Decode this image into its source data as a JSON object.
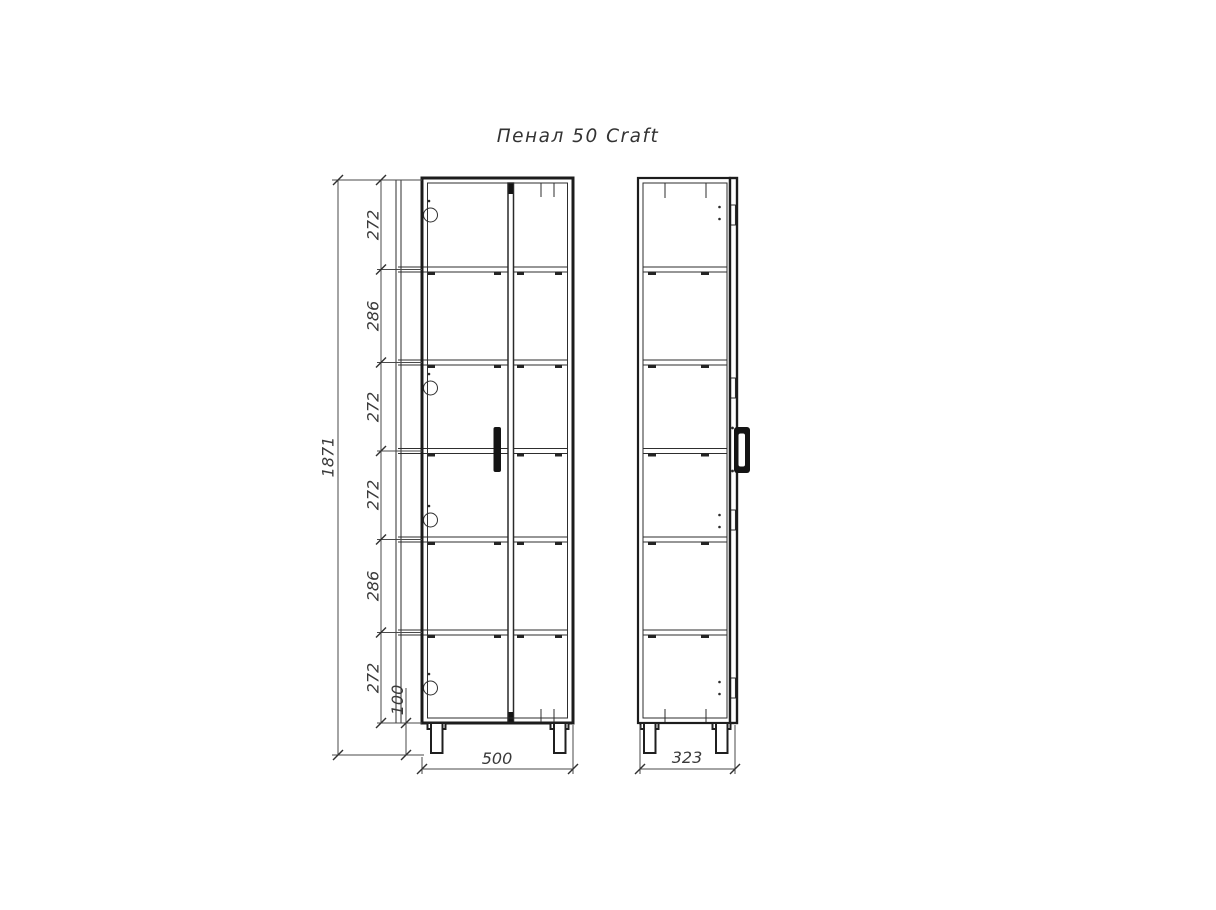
{
  "title": "Пенал 50 Craft",
  "dimensions": {
    "overall_height": "1871",
    "shelf_segments": [
      "272",
      "286",
      "272",
      "272",
      "286",
      "272"
    ],
    "leg_height": "100",
    "front_width": "500",
    "side_depth": "323"
  },
  "colors": {
    "line": "#1c1c1c",
    "text": "#3a3a3a",
    "background": "#ffffff"
  }
}
